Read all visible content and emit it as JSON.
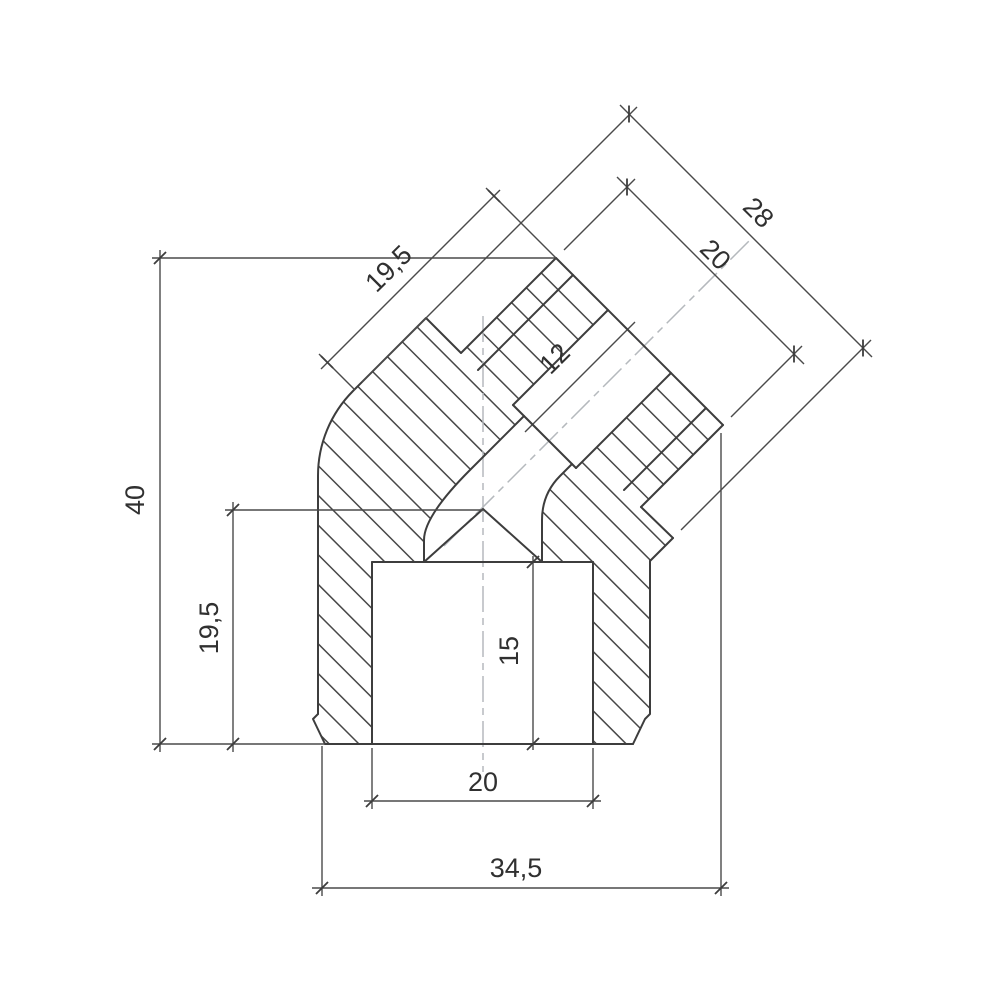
{
  "drawing": {
    "background": "#ffffff",
    "colors": {
      "outline": "#3d3d3d",
      "hatch": "#474747",
      "dimension": "#4a4a4a",
      "tick": "#3d3d3d",
      "centerline": "#b5b9bd",
      "text": "#303030"
    },
    "stroke_widths": {
      "outline": 2,
      "hatch": 1.5,
      "dimension": 1.4,
      "tick": 1.8,
      "centerline": 1.5
    },
    "font_size": 27,
    "part": {
      "outline_paths": [
        {
          "id": "outer-left-and-branch-top",
          "d": "M318,714 L318,476 A120,120 0 0 1 353,391 L426,318 L461,353 L556,258"
        },
        {
          "id": "branch-end-face",
          "d": "M556,258 L723,425"
        },
        {
          "id": "thread-root-top-left",
          "d": "M478,370 L573,275"
        },
        {
          "id": "branch-bore-top-left",
          "d": "M608,310 L513,405"
        },
        {
          "id": "bore-shoulder",
          "d": "M513,405 L576,468"
        },
        {
          "id": "channel-wall-left",
          "d": "M524,416 L470,470 Q424,516 424,540 L424,562"
        },
        {
          "id": "channel-valley",
          "d": "M424,562 L483,509 L542,562"
        },
        {
          "id": "channel-wall-right",
          "d": "M572,464 L560,476 Q542,494 542,520 L542,562"
        },
        {
          "id": "branch-bore-bottom-right",
          "d": "M671,373 L576,468"
        },
        {
          "id": "thread-root-bottom-right",
          "d": "M624,490 L706,408"
        },
        {
          "id": "thread-crest-bottom-right",
          "d": "M641,507 L723,425"
        },
        {
          "id": "thread-relief-step",
          "d": "M673,538 L641,507"
        },
        {
          "id": "base-stub-bottom-right",
          "d": "M650,561 L673,538"
        },
        {
          "id": "outer-right-wall",
          "d": "M650,561 L650,714 L645,719 L633,744"
        },
        {
          "id": "bottom-face",
          "d": "M325,744 L633,744"
        },
        {
          "id": "bottom-left-chamfer",
          "d": "M318,714 L313,719 L325,744"
        },
        {
          "id": "socket-ceiling",
          "d": "M372,562 L593,562"
        },
        {
          "id": "socket-bore-left-wall",
          "d": "M372,562 L372,744"
        },
        {
          "id": "socket-bore-right-wall",
          "d": "M593,562 L593,744"
        }
      ],
      "hatch_regions": [
        {
          "id": "section-material-left",
          "d": "M318,714 L318,476 A120,120 0 0 1 353,391 L426,318 L461,353 L556,258 L608,310 L513,405 L524,416 L470,470 Q424,516 424,540 L424,562 L372,562 L372,744 L325,744 L313,719 Z"
        },
        {
          "id": "section-material-right",
          "d": "M723,425 L671,373 L576,468 L572,464 L560,476 Q542,494 542,520 L542,562 L593,562 L593,744 L633,744 L645,719 L650,714 L650,561 L673,538 L641,507 Z"
        }
      ],
      "centerlines": [
        {
          "id": "vertical-centerline",
          "x1": 483,
          "y1": 316,
          "x2": 483,
          "y2": 772
        },
        {
          "id": "branch-centerline",
          "x1": 444,
          "y1": 546,
          "x2": 752,
          "y2": 238
        }
      ]
    },
    "dimensions": [
      {
        "id": "dim-40",
        "label": "40",
        "label_pos": {
          "x": 144,
          "y": 500,
          "rotate": -90
        },
        "lines": [
          [
            160,
            250,
            160,
            752
          ]
        ],
        "ext_lines": [
          [
            152,
            258,
            556,
            258
          ],
          [
            152,
            744,
            325,
            744
          ]
        ],
        "ticks": [
          [
            160,
            258,
            135
          ],
          [
            160,
            744,
            135
          ]
        ]
      },
      {
        "id": "dim-19-5-left",
        "label": "19,5",
        "label_pos": {
          "x": 218,
          "y": 628,
          "rotate": -90
        },
        "lines": [
          [
            233,
            502,
            233,
            752
          ]
        ],
        "ext_lines": [
          [
            225,
            510,
            483,
            510
          ]
        ],
        "ticks": [
          [
            233,
            510,
            135
          ],
          [
            233,
            744,
            135
          ]
        ]
      },
      {
        "id": "dim-15",
        "label": "15",
        "label_pos": {
          "x": 518,
          "y": 651,
          "rotate": -90
        },
        "lines": [
          [
            533,
            556,
            533,
            750
          ]
        ],
        "ext_lines": [],
        "ticks": [
          [
            533,
            562,
            135
          ],
          [
            533,
            744,
            135
          ]
        ]
      },
      {
        "id": "dim-20-bottom",
        "label": "20",
        "label_pos": {
          "x": 483,
          "y": 791,
          "rotate": 0
        },
        "lines": [
          [
            364,
            801,
            601,
            801
          ]
        ],
        "ext_lines": [
          [
            372,
            748,
            372,
            809
          ],
          [
            593,
            748,
            593,
            809
          ]
        ],
        "ticks": [
          [
            372,
            801,
            135
          ],
          [
            593,
            801,
            135
          ]
        ]
      },
      {
        "id": "dim-34-5",
        "label": "34,5",
        "label_pos": {
          "x": 516,
          "y": 877,
          "rotate": 0
        },
        "lines": [
          [
            312,
            888,
            729,
            888
          ]
        ],
        "ext_lines": [
          [
            322,
            746,
            322,
            896
          ],
          [
            721,
            433,
            721,
            896
          ]
        ],
        "ticks": [
          [
            322,
            888,
            135
          ],
          [
            721,
            888,
            135
          ]
        ]
      },
      {
        "id": "dim-28",
        "label": "28",
        "label_pos": {
          "x": 752,
          "y": 219,
          "rotate": 45
        },
        "lines": [
          [
            620,
            105,
            872,
            357
          ]
        ],
        "ext_lines": [
          [
            362,
            382,
            637,
            107
          ],
          [
            681,
            530,
            871,
            340
          ]
        ],
        "ticks": [
          [
            629,
            114,
            90
          ],
          [
            863,
            348,
            90
          ]
        ]
      },
      {
        "id": "dim-20-branch",
        "label": "20",
        "label_pos": {
          "x": 709,
          "y": 261,
          "rotate": 45
        },
        "lines": [
          [
            617,
            177,
            804,
            364
          ]
        ],
        "ext_lines": [
          [
            564,
            250,
            635,
            179
          ],
          [
            731,
            417,
            802,
            346
          ]
        ],
        "ticks": [
          [
            627,
            187,
            90
          ],
          [
            794,
            354,
            90
          ]
        ]
      },
      {
        "id": "dim-19-5-branch",
        "label": "19,5",
        "label_pos": {
          "x": 395,
          "y": 275,
          "rotate": -45
        },
        "lines": [
          [
            321,
            369,
            500,
            190
          ]
        ],
        "ext_lines": [
          [
            355,
            390,
            319,
            354
          ],
          [
            556,
            258,
            486,
            188
          ]
        ],
        "ticks": [
          [
            327,
            362,
            45
          ],
          [
            494,
            196,
            45
          ]
        ]
      },
      {
        "id": "dim-12",
        "label": "12",
        "label_pos": {
          "x": 561,
          "y": 365,
          "rotate": -45
        },
        "lines": [
          [
            525,
            432,
            635,
            322
          ]
        ],
        "ext_lines": [],
        "ticks": [
          [
            532,
            424,
            45
          ],
          [
            627,
            329,
            45
          ]
        ]
      }
    ]
  }
}
